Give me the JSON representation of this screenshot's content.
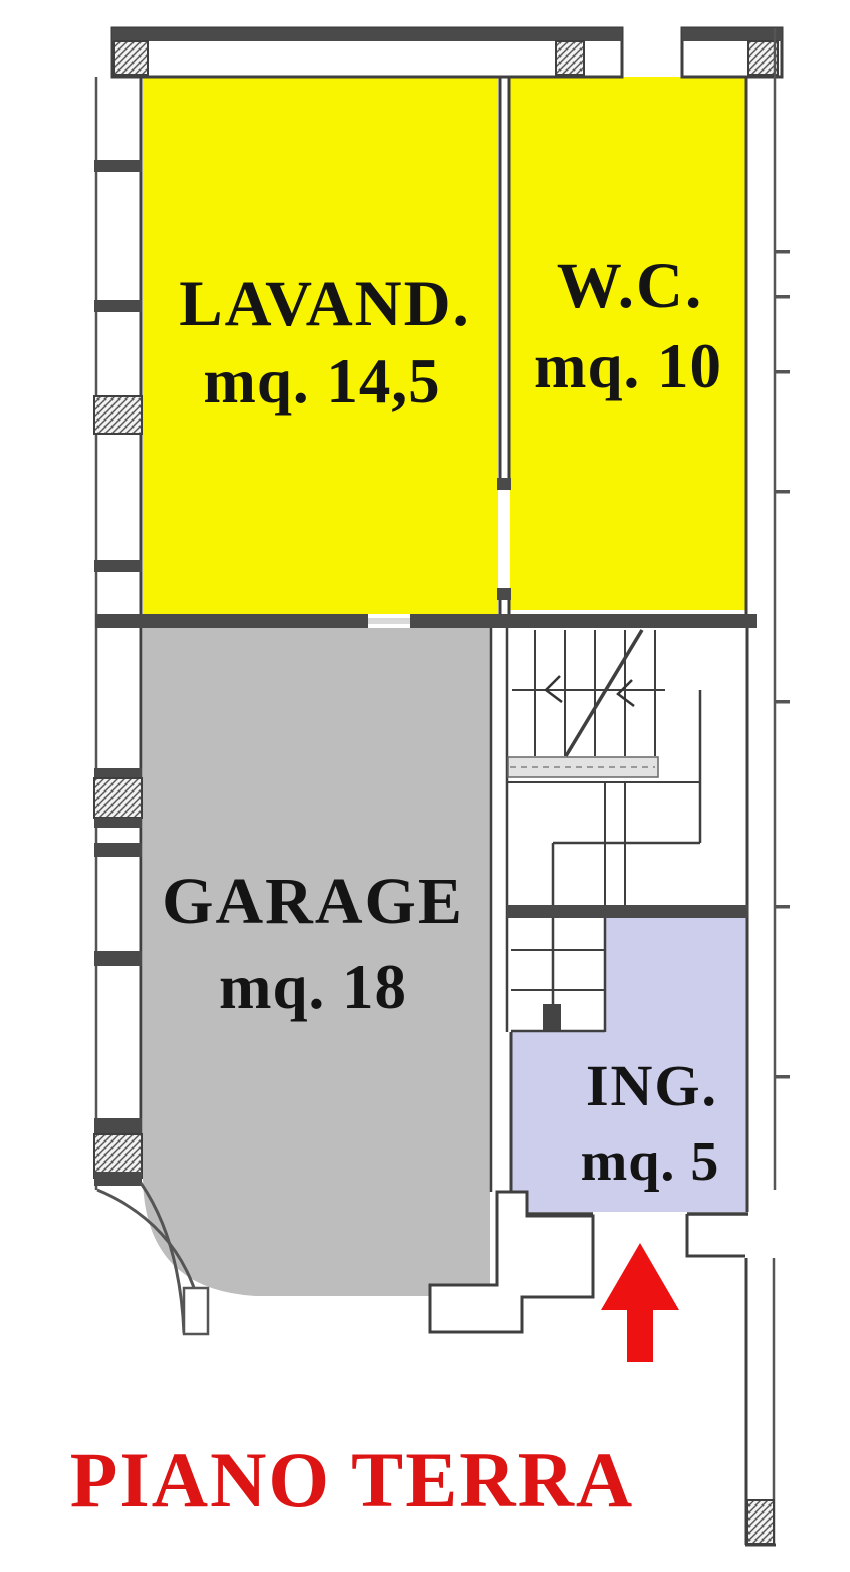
{
  "title": {
    "text": "PIANO TERRA",
    "color": "#dd1414"
  },
  "rooms": [
    {
      "id": "lavanderia",
      "label": "LAVAND.",
      "area_label": "mq. 14,5",
      "fill": "#f9f500"
    },
    {
      "id": "wc",
      "label": "W.C.",
      "area_label": "mq. 10",
      "fill": "#f9f500"
    },
    {
      "id": "garage",
      "label": "GARAGE",
      "area_label": "mq. 18",
      "fill": "#bdbdbd"
    },
    {
      "id": "ingresso",
      "label": "ING.",
      "area_label": "mq. 5",
      "fill": "#cdcdec"
    }
  ],
  "entrance_arrow": {
    "direction": "up",
    "color": "#ee1111"
  },
  "colors": {
    "wall_dark": "#4a4a4a",
    "wall_line": "#3f3f3f",
    "stair_band": "#e2e2e2"
  }
}
